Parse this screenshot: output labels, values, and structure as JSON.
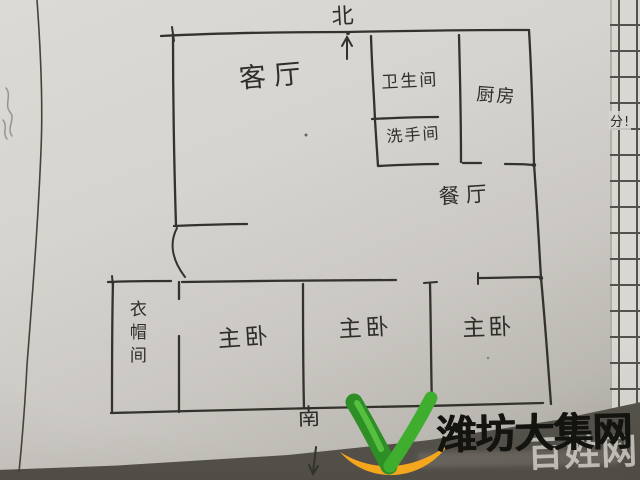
{
  "floor_plan": {
    "compass": {
      "north": "北",
      "south": "南"
    },
    "rooms": {
      "living_room": "客厅",
      "bathroom": "卫生间",
      "washroom": "洗手间",
      "kitchen": "厨房",
      "dining_room": "餐厅",
      "cloakroom": "衣帽间",
      "bedroom_left": "主卧",
      "bedroom_middle": "主卧",
      "bedroom_right": "主卧"
    }
  },
  "notebook_margin": {
    "note": "分!"
  },
  "watermark": {
    "site_name": "潍坊大集网",
    "secondary_site": "百姓网",
    "logo": "v-leaf-logo",
    "colors": {
      "green": "#3fae2e",
      "green_dark": "#2e8f27",
      "orange": "#f4a61d",
      "text": "#131310",
      "secondary_text": "#d4d1ca"
    }
  },
  "ink_color": "#34322d"
}
